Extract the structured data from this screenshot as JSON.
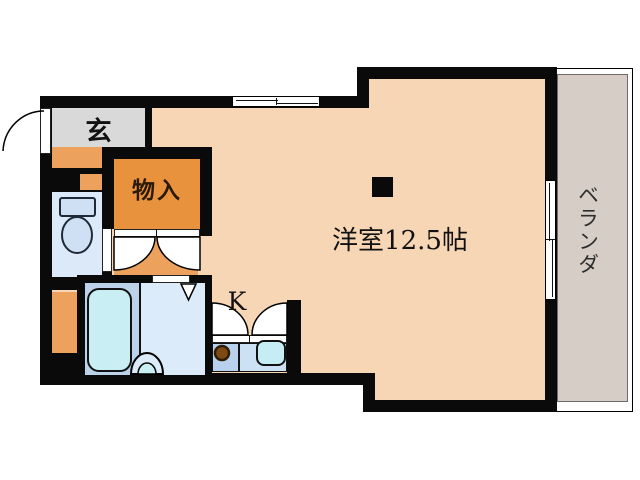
{
  "floorplan": {
    "type": "japanese-apartment-floorplan",
    "rooms": {
      "entrance": {
        "label": "玄"
      },
      "storage": {
        "label": "物入"
      },
      "western_room": {
        "label": "洋室12.5帖"
      },
      "kitchen": {
        "label": "K"
      },
      "balcony": {
        "label": "ベランダ"
      }
    },
    "fixtures": [
      "entry-door-swing",
      "toilet",
      "toilet-door",
      "closet-double-doors",
      "bathtub",
      "washbasin",
      "folding-door-marker",
      "bathroom-door-gap",
      "kitchen-double-doors",
      "kitchen-counter",
      "gas-burner",
      "kitchen-sink",
      "sliding-window-top",
      "sliding-window-right",
      "pillar",
      "balcony-deck"
    ],
    "colors": {
      "wall": "#0a0a0a",
      "room_floor": "#f6d6b4",
      "hall_accent": "#eca25c",
      "storage_fill": "#e9923e",
      "entrance_fill": "#d9d9d9",
      "balcony_fill": "#d6cec6",
      "wet_area_light": "#dcebf9",
      "wet_area_medium": "#bcd2ea",
      "toilet_room_fill": "#dce9f8",
      "fixture_cyan": "#c9eff5",
      "kitchen_cell_left": "#b8d2ee",
      "kitchen_cell_right": "#cde1f5",
      "burner_brown": "#7b4a15"
    }
  }
}
